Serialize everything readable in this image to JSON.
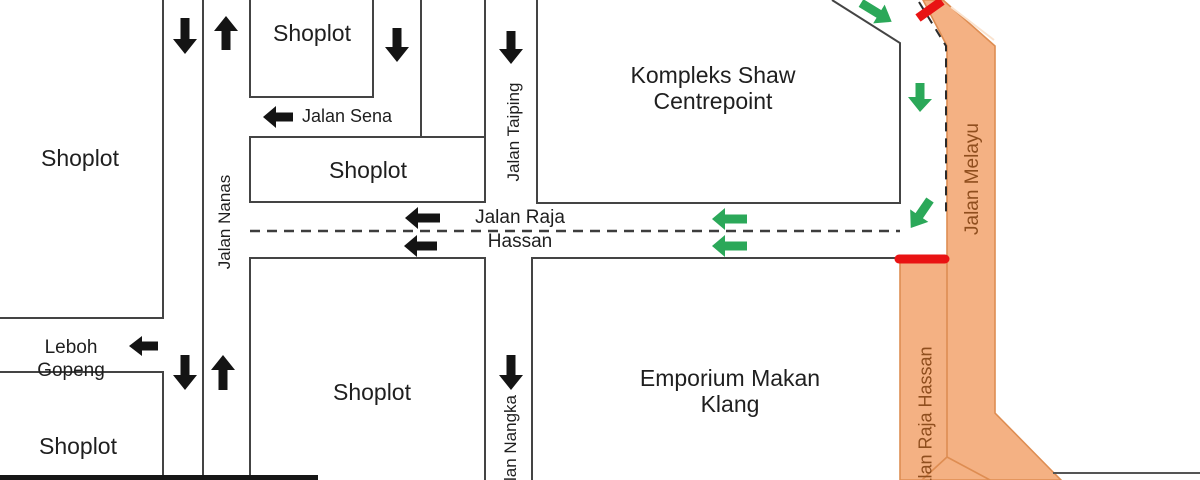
{
  "labels": {
    "shoplot_top_left": "Shoplot",
    "shoplot_top": "Shoplot",
    "shoplot_mid": "Shoplot",
    "shoplot_bottom_left": "Shoplot",
    "shoplot_bottom_mid": "Shoplot",
    "kompleks": "Kompleks Shaw Centrepoint",
    "emporium": "Emporium Makan Klang"
  },
  "streets": {
    "jalan_sena": "Jalan Sena",
    "jalan_nanas": "Jalan Nanas",
    "jalan_taiping": "Jalan Taiping",
    "jalan_raja_hassan_line1": "Jalan Raja",
    "jalan_raja_hassan_line2": "Hassan",
    "leboh_gopeng": "Leboh Gopeng",
    "jalan_nangka": "Jalan Nangka",
    "jalan_melayu": "Jalan Melayu",
    "jalan_raja_hassan_south": "Jalan Raja Hassan"
  },
  "colors": {
    "highlight_road_fill": "#F4B183",
    "highlight_road_border": "#DE8D52",
    "closure_red": "#E91313",
    "flow_green": "#2BA859",
    "road_outline": "#444444",
    "orange_label_brown": "#8F4E1E"
  }
}
